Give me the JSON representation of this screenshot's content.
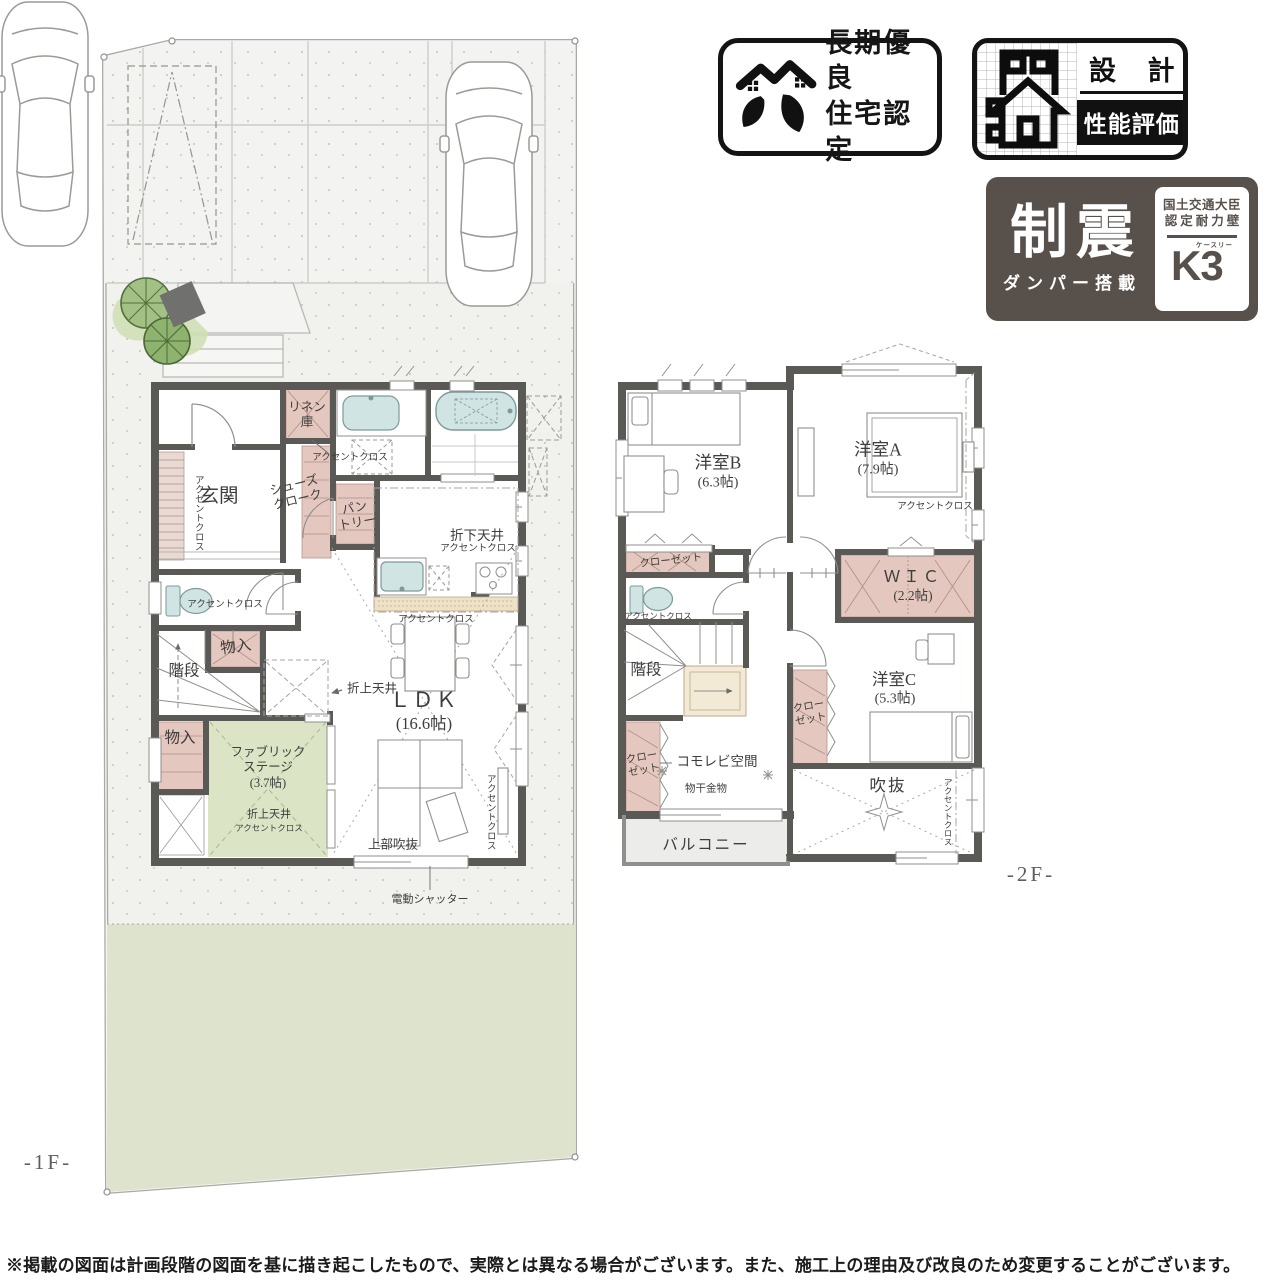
{
  "palette": {
    "wall_gray": "#5b5955",
    "plan_pink": "#e4c7bf",
    "plan_green": "#dbe5c6",
    "fixture_blue": "#cfe4e3",
    "counter_beige": "#efe1c5",
    "garden_green": "#dee3cd",
    "site_gray": "#f1f1ee",
    "badge_dark": "#57504b"
  },
  "floor_tags": {
    "f1": "-1F-",
    "f2": "-2F-"
  },
  "common": {
    "accent": "アクセントクロス",
    "stairs": "階段",
    "storage": "物入"
  },
  "plan1": {
    "linen": "リネン\n庫",
    "entrance": "玄関",
    "shoe_cloak": "シューズ\nクローク",
    "pantry": "パン\nトリー",
    "lowered_ceiling": "折下天井",
    "raised_ceiling": "折上天井",
    "ldk": "ＬＤＫ",
    "ldk_size": "(16.6帖)",
    "fabric_stage": "ファブリック\nステージ\n(3.7帖)",
    "upper_void": "上部吹抜",
    "shutter": "電動シャッター"
  },
  "plan2": {
    "room_b": "洋室B",
    "room_b_size": "(6.3帖)",
    "room_a": "洋室A",
    "room_a_size": "(7.9帖)",
    "closet": "クローゼット",
    "closet_two_line": "クロー\nゼット",
    "wic": "ＷＩＣ",
    "wic_size": "(2.2帖)",
    "room_c": "洋室C",
    "room_c_size": "(5.3帖)",
    "komorebi": "コモレビ空間",
    "laundry": "物干金物",
    "void": "吹抜",
    "balcony": "バルコニー"
  },
  "badges": {
    "longlife": {
      "line1": "長期優良",
      "line2": "住宅認定"
    },
    "design": {
      "top": "設 計",
      "bottom": "性能評価"
    },
    "seismic": {
      "main": "制震",
      "sub": "ダンパー搭載",
      "cert_line1": "国土交通大臣",
      "cert_line2": "認定耐力壁",
      "brand": "K3",
      "brand_ruby": "ケースリー"
    }
  },
  "footer": {
    "disclaimer": "※掲載の図面は計画段階の図面を基に描き起こしたもので、実際とは異なる場合がございます。また、施工上の理由及び改良のため変更することがございます。"
  }
}
